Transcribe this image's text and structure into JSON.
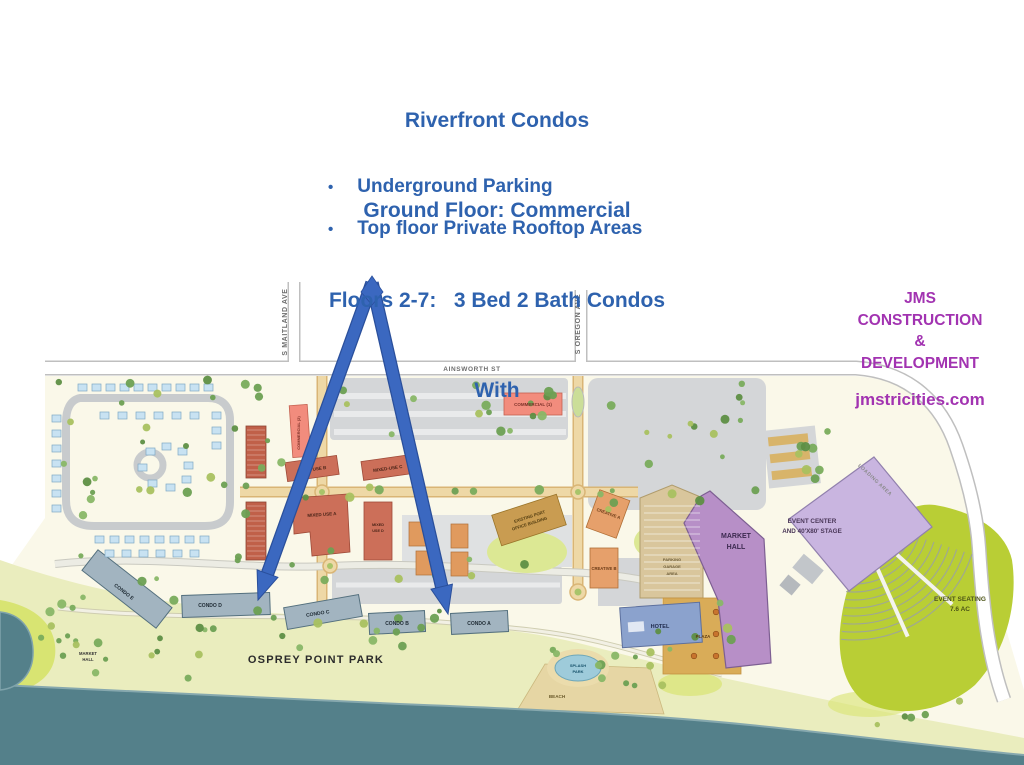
{
  "slide": {
    "title_lines": [
      "Riverfront Condos",
      "Ground Floor: Commercial",
      "Floors 2-7:   3 Bed 2 Bath Condos",
      "With"
    ],
    "bullet_char": "•",
    "bullets": [
      "Underground Parking",
      "Top floor Private Rooftop Areas"
    ]
  },
  "branding": {
    "line1": "JMS",
    "line2": "CONSTRUCTION",
    "line3": "&",
    "line4": "DEVELOPMENT",
    "website": "jmstricities.com"
  },
  "colors": {
    "title_blue": "#2E62AE",
    "brand_purple": "#A233B1",
    "arrow_blue": "#3B68C0",
    "water_teal": "#54808A",
    "event_lawn_green": "#B9CE35",
    "market_hall_purple": "#B78FC7",
    "event_center_purple": "#C9B5E0"
  },
  "map": {
    "streets": {
      "maitland": "S MAITLAND AVE",
      "oregon": "S OREGON AVE",
      "ainsworth": "AINSWORTH ST"
    },
    "buildings": {
      "commercial1": "COMMERCIAL (1)",
      "commercial2": "COMMERCIAL (2)",
      "mixed_a": "MIXED USE A",
      "mixed_b": "MIXED USE B",
      "mixed_c": "MIXED-USE C",
      "mixed_d_l1": "MIXED",
      "mixed_d_l2": "USE D",
      "port_office_l1": "EXISTING PORT",
      "port_office_l2": "OFFICE BUILDING",
      "creative_a": "CREATIVE A",
      "creative_b": "CREATIVE B",
      "parking_garage_l1": "PARKING",
      "parking_garage_l2": "GARAGE",
      "parking_garage_l3": "AREA",
      "market_hall_l1": "MARKET",
      "market_hall_l2": "HALL",
      "hotel": "HOTEL",
      "plaza": "PLAZA",
      "event_center_l1": "EVENT CENTER",
      "event_center_l2": "AND 40'X80' STAGE",
      "condo_a": "CONDO A",
      "condo_b": "CONDO B",
      "condo_c": "CONDO C",
      "condo_d": "CONDO D",
      "condo_e": "CONDO E"
    },
    "places": {
      "osprey": "OSPREY POINT PARK",
      "market_hall_small_l1": "MARKET",
      "market_hall_small_l2": "HALL",
      "splash_l1": "SPLASH",
      "splash_l2": "PARK",
      "beach": "BEACH",
      "event_seating_l1": "EVENT SEATING",
      "event_seating_l2": "7.6 AC",
      "loading": "LOADING AREA"
    }
  }
}
